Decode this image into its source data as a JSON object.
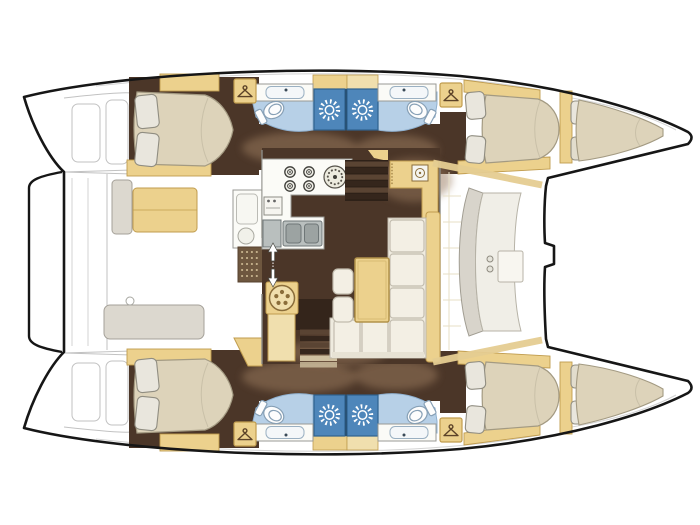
{
  "meta": {
    "title": "Catamaran yacht interior layout - top view floor plan",
    "width": 700,
    "height": 525
  },
  "palette": {
    "outline": "#161616",
    "sketch": "#bfbfbf",
    "paper": "#ffffff",
    "white": "#ffffff",
    "floor_dark": "#4b3628",
    "floor_shadow": "#97785b",
    "wood": "#ecd18d",
    "wood_dark": "#c09c4e",
    "wood_light": "#f0dfae",
    "mattress": "#ddd3ba",
    "mattress_edge": "#a39a82",
    "pillow": "#e9e6dd",
    "pillow_edge": "#908d81",
    "bath_floor": "#b7d0e7",
    "bath_edge": "#8fb0cf",
    "shower_blue": "#4e86ba",
    "shower_edge": "#2f628f",
    "counter": "#fbfbf7",
    "counter_edge": "#9a9a94",
    "steel": "#b9bfbe",
    "steel_dark": "#6f7778",
    "bench_gray": "#dcd8cf",
    "bench_edge": "#a5a199",
    "seat_white": "#f3efe4",
    "seat_edge": "#c2bcae",
    "step_dark": "#35261c",
    "step_mid": "#5a4433",
    "step_light": "#cfc0a0",
    "grate": "#6e573f",
    "grate_dot": "#c9b690",
    "hanger_glyph": "#5c4328"
  },
  "legend": {
    "hulls": 2,
    "double_cabins": 4,
    "heads": 4,
    "showers": 4,
    "forepeak_berths": 2,
    "companionway_stairs": 2
  },
  "fixtures": {
    "galley": [
      "four-burner-stove",
      "round-hotplate",
      "oven",
      "double-sink",
      "front-load-appliance"
    ],
    "salon": [
      "l-shaped-sofa",
      "dining-table",
      "two-stools",
      "chart-seat"
    ],
    "head": [
      "toilet",
      "wash-basin",
      "shower-rose"
    ],
    "cabin": [
      "double-berth",
      "two-pillows",
      "wardrobe-hanger"
    ],
    "cockpit": [
      "bench-seat",
      "aft-locker",
      "deck-grate",
      "transom-steps",
      "aft-crossbeam"
    ],
    "foredeck": [
      "curved-lounge-seat",
      "bow-lockers"
    ]
  },
  "icons": [
    "wardrobe-hanger-icon",
    "shower-rose-icon",
    "burner-icon",
    "up-down-steps-arrow-icon"
  ]
}
